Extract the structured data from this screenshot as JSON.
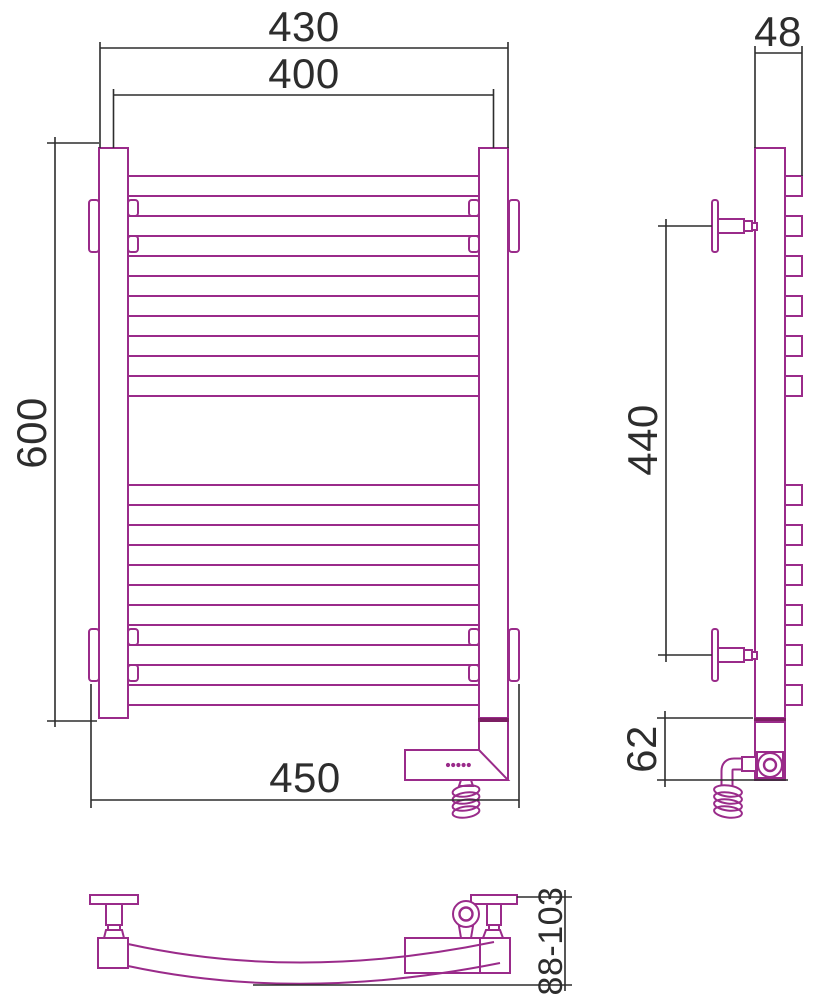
{
  "drawing": {
    "dimensions": {
      "overall_width": "430",
      "rail_width": "400",
      "overall_height": "600",
      "side_depth": "48",
      "bracket_vertical_span": "440",
      "mounting_width": "450",
      "heater_section_height": "62",
      "wall_offset_range": "88-103"
    },
    "indicator_dots": 5,
    "colors": {
      "product_outline": "#9a2b8a",
      "product_dark": "#7c1f63",
      "dimension_lines": "#2d2d2d",
      "background": "#ffffff"
    }
  }
}
